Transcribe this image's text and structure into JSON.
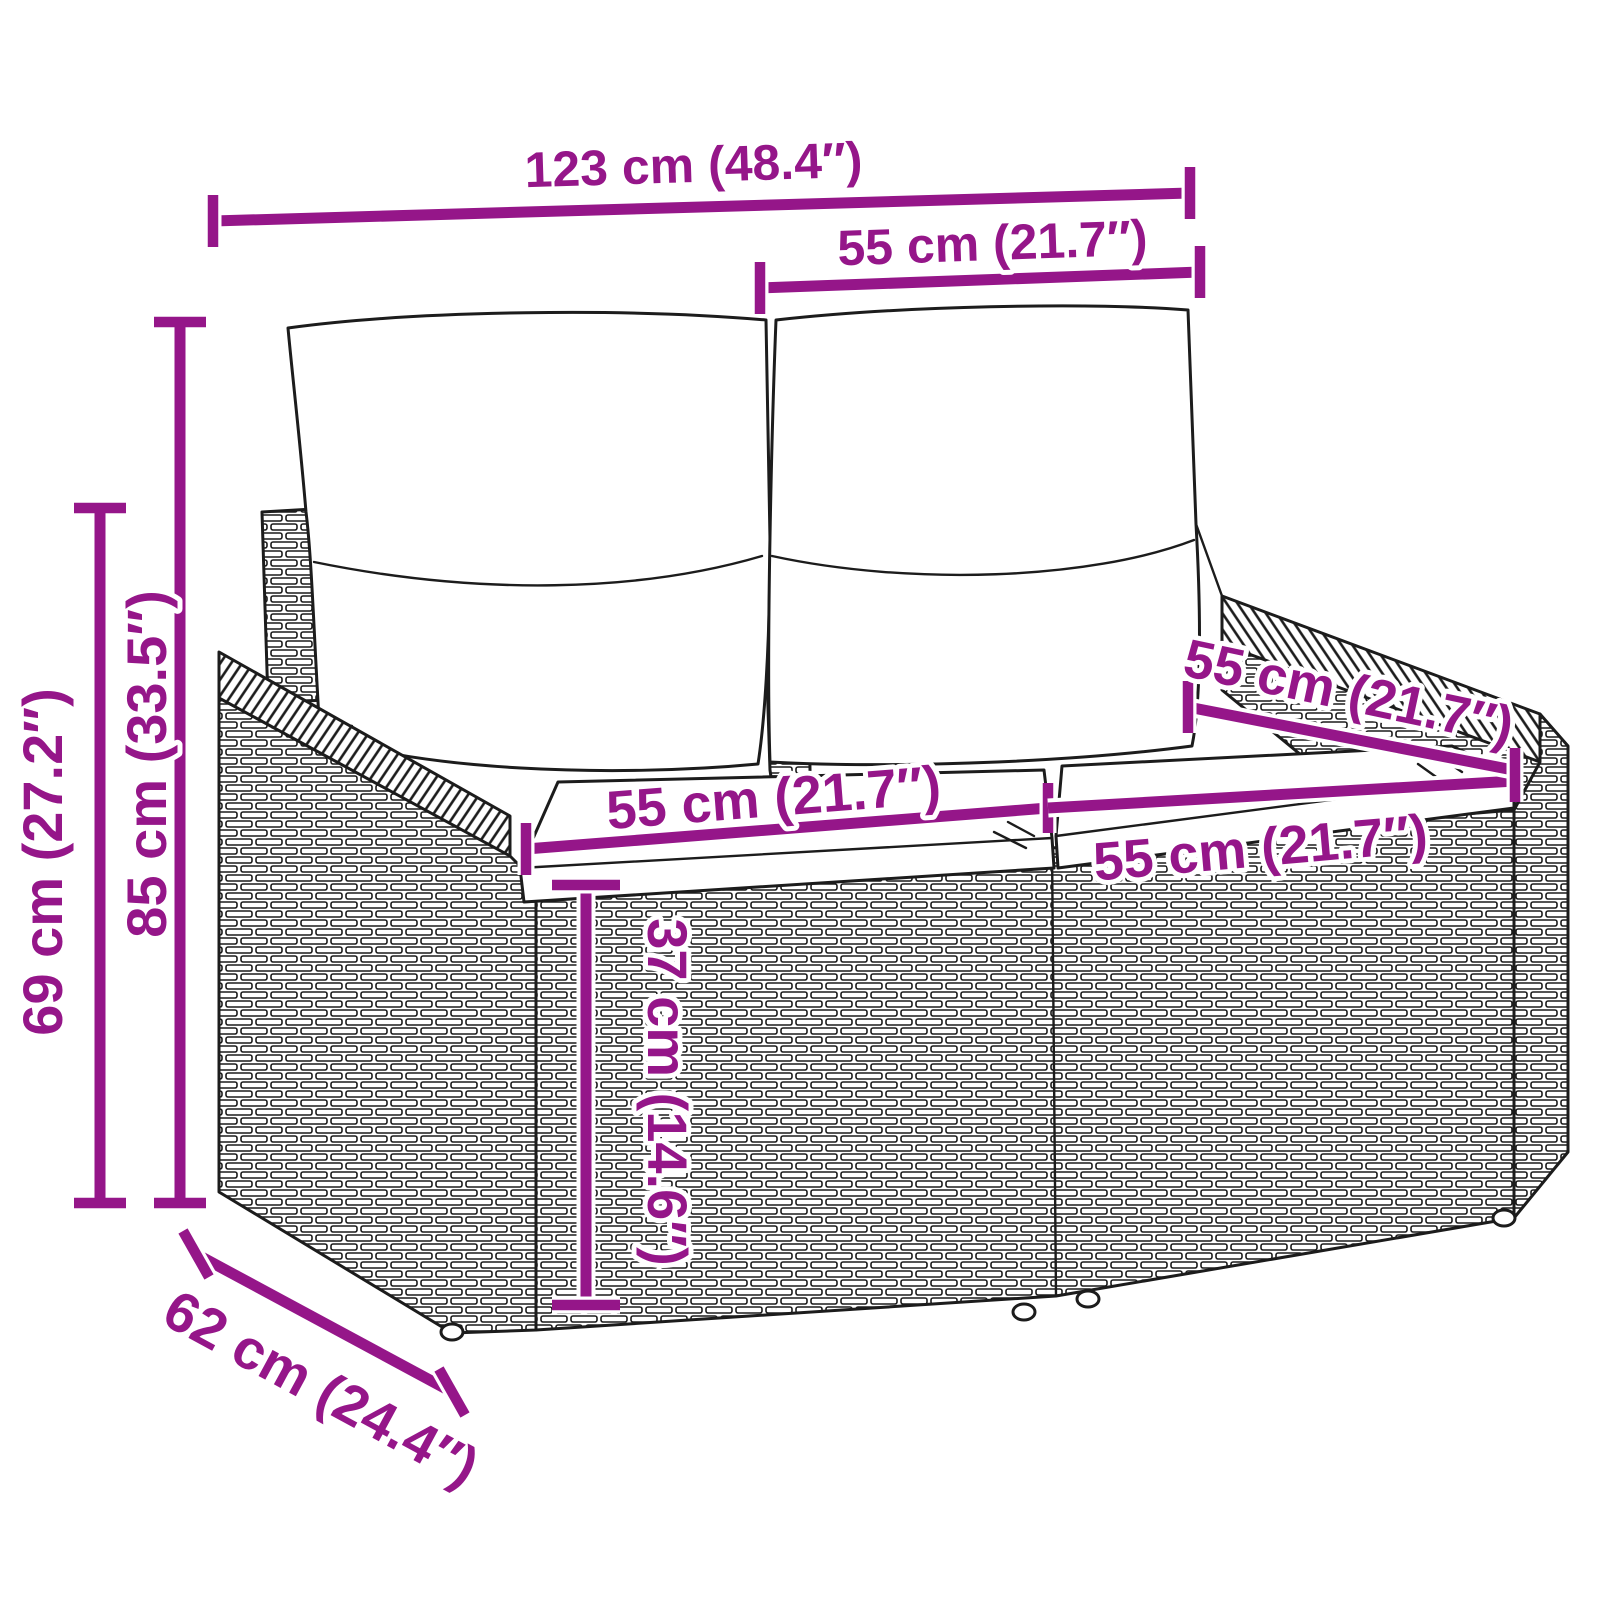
{
  "figure": {
    "kind": "product dimension diagram",
    "subject": "poly rattan 2-seater garden sofa with back and seat cushions",
    "background_color": "#ffffff",
    "sketch_color": "#1c1c1c",
    "accent_color": "#951689"
  },
  "dims": {
    "overall_width": {
      "label": "123 cm (48.4″)",
      "cm": 123,
      "inches": 48.4
    },
    "back_width": {
      "label": "55 cm (21.7″)",
      "cm": 55,
      "inches": 21.7
    },
    "side_height": {
      "label": "69 cm (27.2″)",
      "cm": 69,
      "inches": 27.2
    },
    "total_height": {
      "label": "85 cm (33.5″)",
      "cm": 85,
      "inches": 33.5
    },
    "seat_width_left": {
      "label": "55 cm (21.7″)",
      "cm": 55,
      "inches": 21.7
    },
    "seat_width_right": {
      "label": "55 cm (21.7″)",
      "cm": 55,
      "inches": 21.7
    },
    "seat_depth": {
      "label": "55 cm (21.7″)",
      "cm": 55,
      "inches": 21.7
    },
    "seat_height": {
      "label": "37 cm (14.6″)",
      "cm": 37,
      "inches": 14.6
    },
    "overall_depth": {
      "label": "62 cm (24.4″)",
      "cm": 62,
      "inches": 24.4
    }
  }
}
